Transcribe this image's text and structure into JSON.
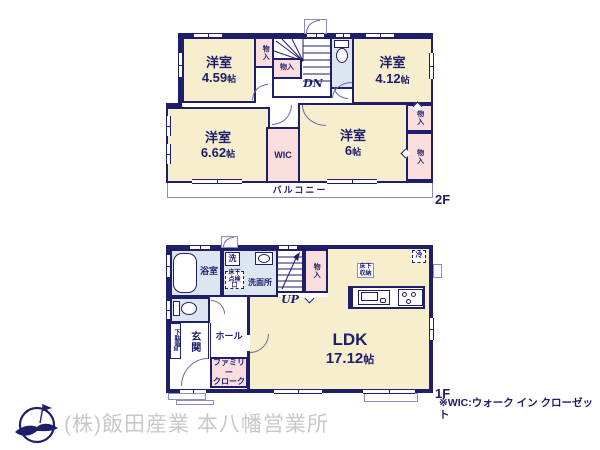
{
  "colors": {
    "wall_navy": "#1e1e6b",
    "room_beige": "#f7eecd",
    "closet_pink": "#fadddd",
    "wet_area_blue": "#dde5f1",
    "company_gray": "#c8c8c6"
  },
  "floor2": {
    "floor_label": "2F",
    "balcony_label": "バルコニー",
    "stairs_label": "DN",
    "room_459": {
      "name": "洋室",
      "size": "4.59",
      "unit": "帖"
    },
    "room_412": {
      "name": "洋室",
      "size": "4.12",
      "unit": "帖"
    },
    "room_662": {
      "name": "洋室",
      "size": "6.62",
      "unit": "帖"
    },
    "room_6": {
      "name": "洋室",
      "size": "6",
      "unit": "帖"
    },
    "wic_label": "WIC",
    "closet_top_left": "物入",
    "closet_under_stairs": "物入",
    "closet_right_upper": "物入",
    "closet_right_lower": "物入"
  },
  "floor1": {
    "floor_label": "1F",
    "stairs_label": "UP",
    "ldk": {
      "name": "LDK",
      "size": "17.12",
      "unit": "帖"
    },
    "bathroom_label": "浴室",
    "washroom_label": "洗面所",
    "laundry_label": "洗",
    "underfloor_hatch": {
      "line1": "床下",
      "line2": "点検口"
    },
    "underfloor_storage": {
      "line1": "床下",
      "line2": "収納"
    },
    "fridge_label": "冷",
    "closet_label": "物入",
    "entrance_label": "玄関",
    "shoe_cabinet_label": "下駄箱M",
    "hall_label": "ホール",
    "family_closet": {
      "line1": "ファミリー",
      "line2": "クローク"
    }
  },
  "footer": {
    "wic_note": "※WIC:ウォーク イン クローゼット",
    "company_name": "(株)飯田産業 本八幡営業所"
  }
}
